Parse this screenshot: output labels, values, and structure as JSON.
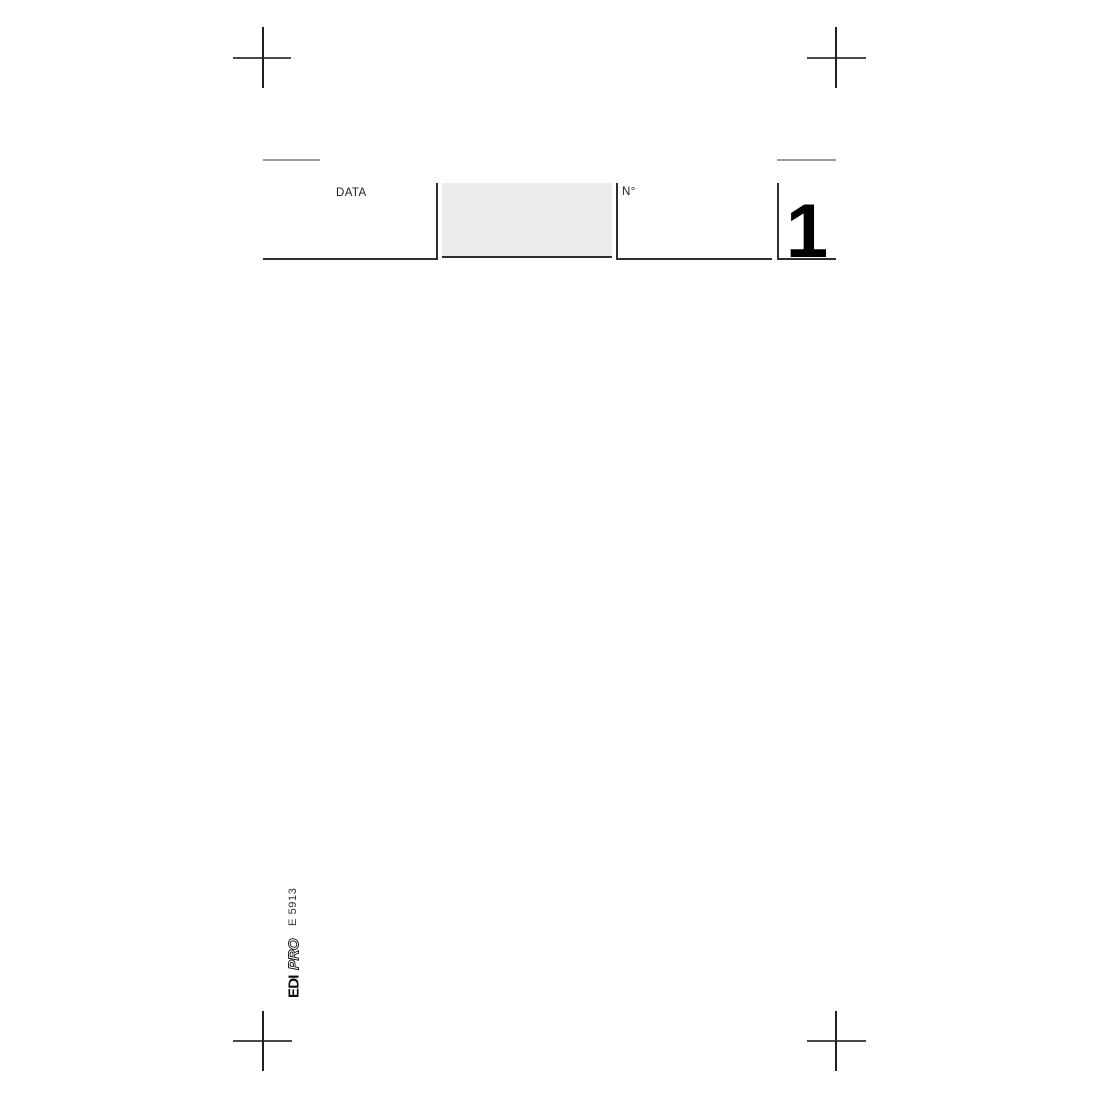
{
  "header": {
    "date_label": "DATA",
    "number_label": "N°",
    "page_number": "1"
  },
  "footer": {
    "brand_edi": "EDI",
    "brand_pro": "PRO",
    "form_code": "E 5913"
  },
  "colors": {
    "page_background": "#ffffff",
    "rule_dark": "#2e2e2e",
    "rule_gray": "#9a9a9a",
    "crop_mark_h": "#4a4a4a",
    "crop_mark_v": "#1f1f1f",
    "shaded_field_fill": "#ececec",
    "label_text": "#1e1e1e",
    "page_number_text": "#000000"
  },
  "icons": {
    "crop_marks": "plus-crosshair"
  }
}
